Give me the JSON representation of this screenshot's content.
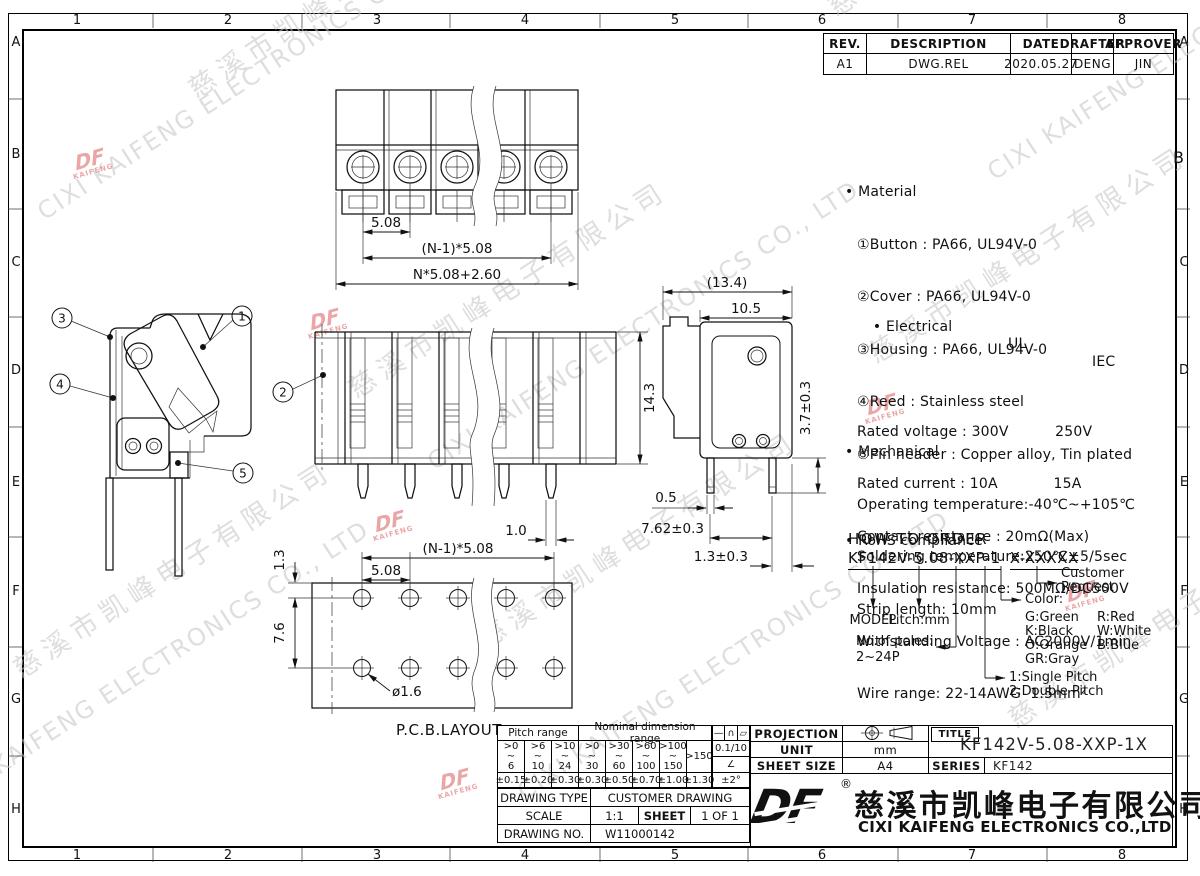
{
  "sheet": {
    "zones_top": [
      "1",
      "2",
      "3",
      "4",
      "5",
      "6",
      "7",
      "8"
    ],
    "zones_side": [
      "A",
      "B",
      "C",
      "D",
      "E",
      "F",
      "G",
      "H"
    ]
  },
  "watermark": {
    "zh": "慈溪市凯峰电子有限公司",
    "en": "CIXI KAIFENG ELECTRONICS CO., LTD",
    "logo_df": "DF",
    "logo_kaifeng": "KAIFENG"
  },
  "revision": {
    "headers": [
      "REV.",
      "DESCRIPTION",
      "DATE",
      "DRAFTER",
      "APPROVER"
    ],
    "row": [
      "A1",
      "DWG.REL",
      "2020.05.27",
      "DENG",
      "JIN"
    ]
  },
  "notes": {
    "material_title": "• Material",
    "material_1": "①Button : PA66, UL94V-0",
    "material_2": "②Cover : PA66, UL94V-0",
    "material_3": "③Housing : PA66, UL94V-0",
    "material_4": "④Reed : Stainless steel",
    "material_5": "⑤Pin header : Copper alloy, Tin plated",
    "electrical_title": "• Electrical",
    "electrical_col1": "UL",
    "electrical_col2": "IEC",
    "electrical_1": "Rated voltage : 300V          250V",
    "electrical_2": "Rated current : 10A            15A",
    "electrical_3": "Contact resistance : 20mΩ(Max)",
    "electrical_4": "Insulation resistance: 500MΩ/DC500V",
    "electrical_5": "Withstanding Voltage : AC2000V/1min",
    "electrical_6": "Wire range: 22-14AWG  1.5mm²",
    "mechanical_title": "• Mechanical",
    "mechanical_1": "Operating temperature:-40℃~+105℃",
    "mechanical_2": "Soldering temperature:250℃±5/5sec",
    "mechanical_3": "Strip length: 10mm",
    "rohs": "• RoHS compliance"
  },
  "order": {
    "title": "HOW TO ORDER",
    "code_left": "KF142V-5.08-XXP-1",
    "code_right": "X-XXXXX",
    "model": "MODEL",
    "pitch": "Pitch:mm",
    "poles_1": "No.of poles:",
    "poles_2": "2~24P",
    "color_title": "Color:",
    "colors": [
      [
        "G:Green",
        "R:Red"
      ],
      [
        "K:Black",
        "W:White"
      ],
      [
        "O:Orange",
        "B:Blue"
      ],
      [
        "GR:Gray",
        ""
      ]
    ],
    "pitch_type_1": "1:Single Pitch",
    "pitch_type_2": "2:Double Pitch",
    "customer_1": "Customer",
    "customer_2": "Request"
  },
  "callouts": {
    "c1": "1",
    "c2": "2",
    "c3": "3",
    "c4": "4",
    "c5": "5"
  },
  "dims": {
    "top_pitch": "5.08",
    "top_span": "(N-1)*5.08",
    "top_total": "N*5.08+2.60",
    "front_height": "14.3",
    "front_pin": "1.0",
    "side_total": "(13.4)",
    "side_body": "10.5",
    "side_pin_len": "3.7±0.3",
    "side_pin_w": "0.5",
    "side_pin_pitch": "7.62±0.3",
    "side_pin_off": "1.3±0.3",
    "pcb_edge": "1.3",
    "pcb_rows": "7.6",
    "pcb_span": "(N-1)*5.08",
    "pcb_pitch": "5.08",
    "pcb_hole": "ø1.6"
  },
  "pcb_label": "P.C.B.LAYOUT",
  "title_block": {
    "pitch_range": "Pitch range",
    "nominal_range": "Nominal dimension range",
    "sym_line": "—",
    "sym_arc": "∩",
    "sym_para": "▱",
    "pr1": ">0\n~\n6",
    "pr2": ">6\n~\n10",
    "pr3": ">10\n~\n24",
    "nr1": ">0\n~\n30",
    "nr2": ">30\n~\n60",
    "nr3": ">60\n~\n100",
    "nr4": ">100\n~\n150",
    "nr5": ">150",
    "frac": "0.1/10",
    "angle": "∠",
    "tol": [
      "±0.15",
      "±0.20",
      "±0.30",
      "±0.30",
      "±0.50",
      "±0.70",
      "±1.00",
      "±1.30",
      "±2°"
    ],
    "drawing_type_label": "DRAWING TYPE",
    "drawing_type": "CUSTOMER DRAWING",
    "scale_label": "SCALE",
    "scale": "1:1",
    "sheet_label": "SHEET",
    "sheet": "1 OF 1",
    "drawing_no_label": "DRAWING NO.",
    "drawing_no": "W11000142",
    "projection": "PROJECTION",
    "unit_label": "UNIT",
    "unit": "mm",
    "sheet_size_label": "SHEET SIZE",
    "sheet_size": "A4",
    "title_label": "TITLE",
    "title": "KF142V-5.08-XXP-1X",
    "series_label": "SERIES",
    "series": "KF142",
    "reg": "®",
    "company_zh": "慈溪市凯峰电子有限公司",
    "company_en": "CIXI KAIFENG ELECTRONICS CO.,LTD"
  }
}
